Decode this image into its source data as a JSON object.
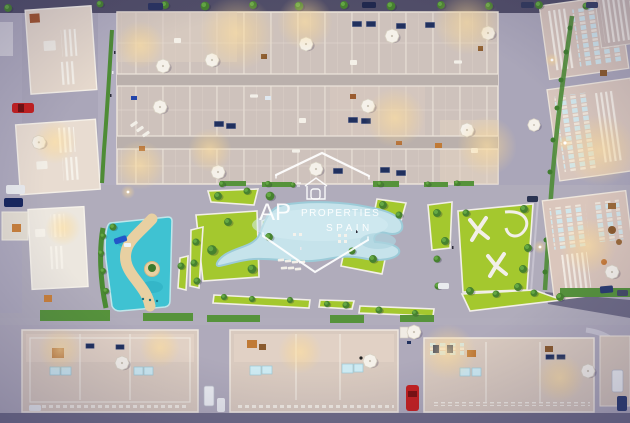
{
  "scene": {
    "type": "aerial-3d-render",
    "description": "Top-down dusk render of a residential complex with a lagoon pool, kids lazy-river pool, lawns, rooftop terraces and streets with parked cars",
    "time_of_day": "dusk"
  },
  "watermark": {
    "brand_prefix": "AP",
    "brand_name": "PROPERTIES",
    "brand_country": "SPAIN"
  },
  "palette": {
    "pavement": "#aaa6b9",
    "road_dark": "#514e68",
    "road_bottom": "#6f6c87",
    "building_beige": "#d0c3bc",
    "building_light": "#e8dcd1",
    "parapet_white": "#f2ece4",
    "lawn_green": "#a4c82e",
    "hedge_green": "#4e8c36",
    "tree_green": "#47822f",
    "lagoon_blue": "#c6e3eb",
    "kids_pool_teal": "#3fc2d2",
    "sand": "#e8d0a2",
    "solar_navy": "#20305e",
    "skylight_cyan": "#cdeaf2",
    "warm_light": "#ffdf9e",
    "car_red": "#c41f1f",
    "car_blue": "#1f3f9e",
    "watermark_white": "#ffffff"
  }
}
